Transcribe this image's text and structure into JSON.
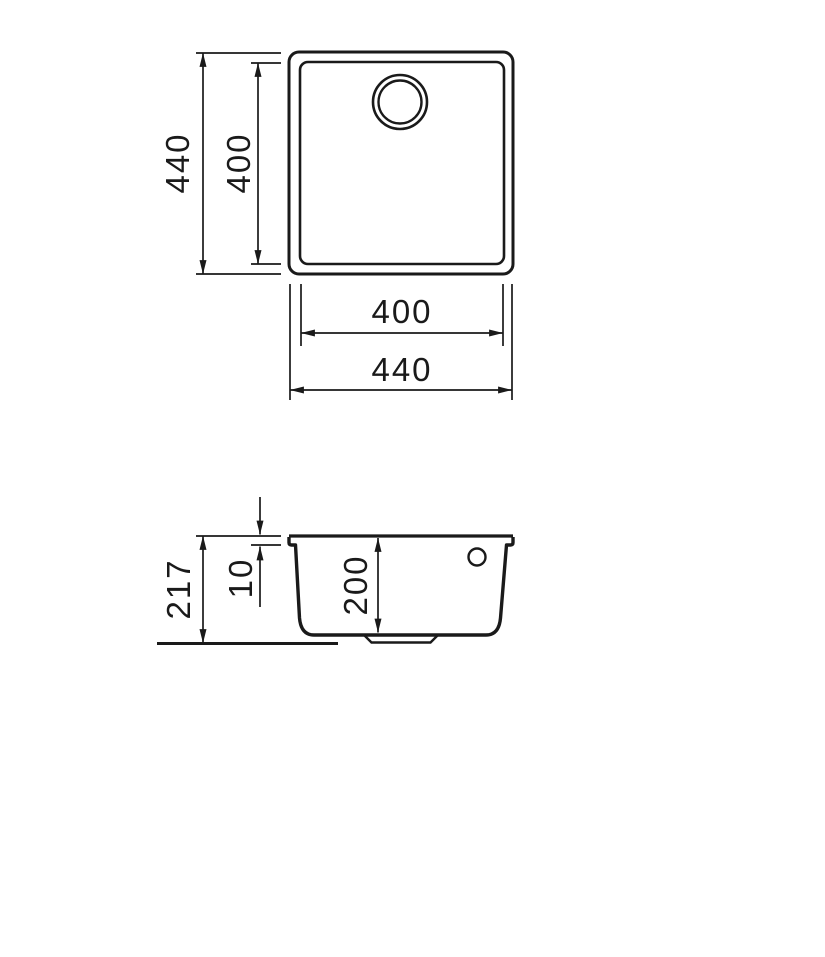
{
  "drawing": {
    "background_color": "#ffffff",
    "line_color": "#1a1a1a"
  },
  "top_view": {
    "outer_height_label": "440",
    "inner_height_label": "400",
    "inner_width_label": "400",
    "outer_width_label": "440"
  },
  "section_view": {
    "overall_height_label": "217",
    "rim_height_label": "10",
    "bowl_depth_label": "200"
  }
}
